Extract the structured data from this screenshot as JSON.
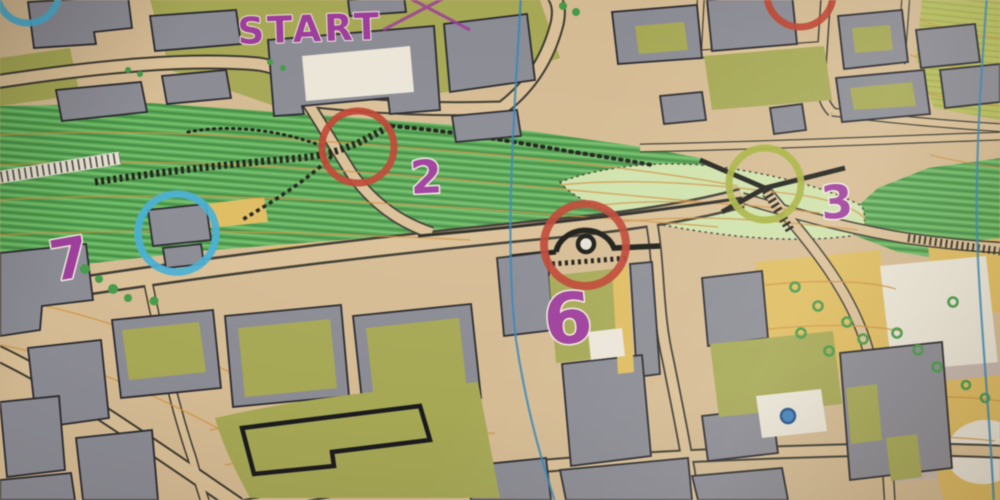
{
  "photo": {
    "description": "Angled close-up photograph of a sprint orienteering course map",
    "start_label": "START",
    "course_color": "#a23a9e",
    "controls": [
      {
        "number": "2",
        "circle_color": "#c5402d"
      },
      {
        "number": "3",
        "circle_color": "#a8b437"
      },
      {
        "number": "6",
        "circle_color": "#c5402d"
      },
      {
        "number": "7",
        "circle_color": "#3fb0d8"
      }
    ],
    "edge_circles": [
      {
        "position": "top-left",
        "color": "#3fb0d8"
      },
      {
        "position": "top-right",
        "color": "#c5402d"
      }
    ]
  },
  "palette": {
    "paved_tan": "#d7bb8f",
    "road_tan": "#dcc093",
    "road_edge": "#3a372c",
    "building_gray": "#8a8a94",
    "building_outline": "#26262c",
    "slope_green": "#55aa50",
    "slope_stripe_dark": "#3d8e3e",
    "pale_green": "#cfe3a8",
    "olive_green": "#a6a84e",
    "open_yellow": "#e2bc58",
    "white_area": "#ece7d8",
    "pink_paving": "#c6b6ae",
    "contour_orange": "#d4913a",
    "north_line_blue": "#2f86bb",
    "detail_black": "#1d1d16",
    "tree_green": "#3f9b42",
    "water_blue": "#3b82c4"
  }
}
